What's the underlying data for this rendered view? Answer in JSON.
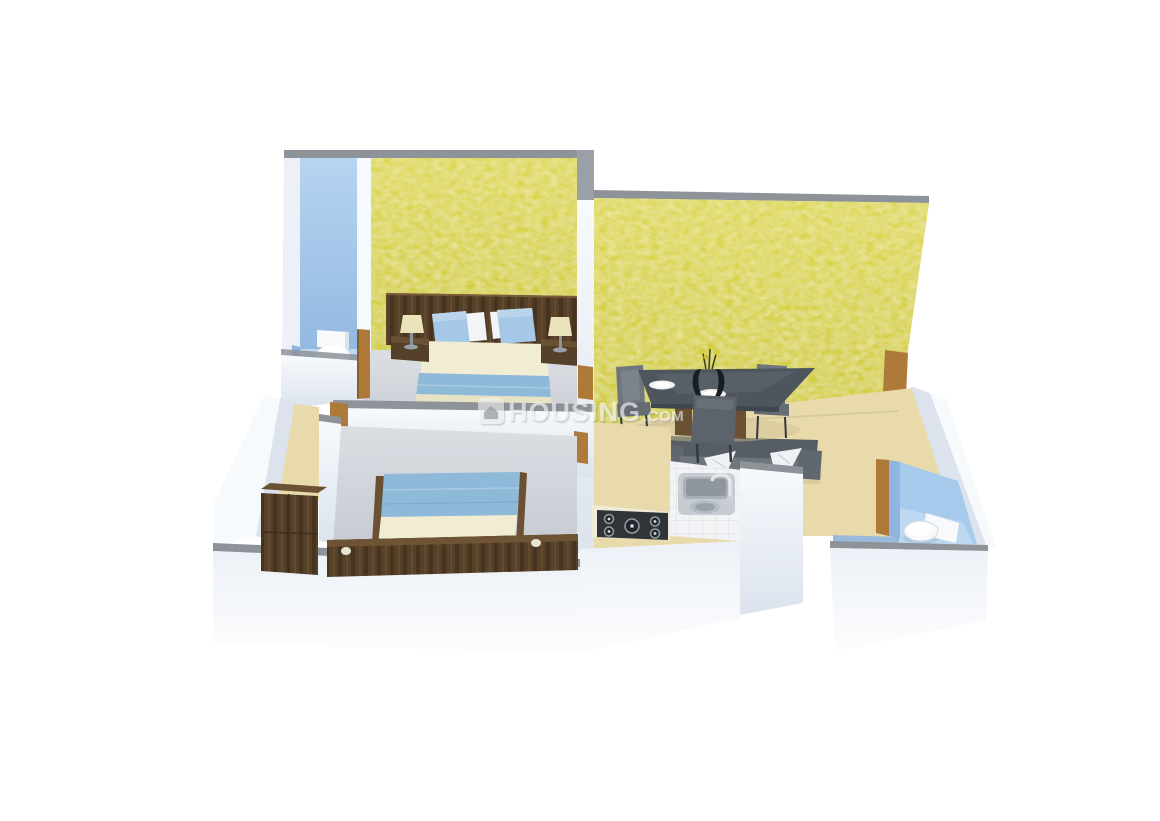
{
  "watermark": {
    "icon": "housing-logo-icon",
    "brand": "HOUSING",
    "suffix": ".COM"
  },
  "palette": {
    "background": "#ffffff",
    "yellow_wall": "#d2cd3f",
    "yellow_wall_light": "#ded957",
    "gray_wall_top": "#8e939a",
    "white_wall": "#edf1f7",
    "white_wall_bright": "#f7fafd",
    "white_wall_shadow": "#dde3ed",
    "blue_wall": "#a7cbed",
    "blue_wall_deep": "#8fb6e0",
    "blue_floor": "#bdd8f0",
    "beige_floor": "#e9daab",
    "beige_floor_deep": "#e0d09e",
    "gray_floor": "#d5d8dd",
    "wood_trim": "#ad7a3a",
    "wood_dark": "#55402a",
    "wood_mid": "#6b5134",
    "bed_cream": "#f0edd3",
    "bed_blue": "#8fb9d9",
    "pillow_blue": "#a5c8e6",
    "lamp_cream": "#eae2ba",
    "sofa_gray": "#565d64",
    "table_gray": "#4e555c",
    "chair_gray": "#70767e",
    "fixture_white": "#f7f9fb",
    "hob_black": "#2f3439",
    "steel": "#c7ccd2",
    "watermark": "#ffffff"
  },
  "scene": {
    "type": "3d-isometric-floor-plan",
    "rooms": [
      {
        "id": "bathroom-1",
        "wall_color_key": "blue_wall",
        "fixtures": [
          "toilet"
        ]
      },
      {
        "id": "bedroom-1",
        "wall_color_key": "yellow_wall",
        "furniture": [
          "double-bed",
          "headboard",
          "nightstand-left",
          "nightstand-right",
          "table-lamp-left",
          "table-lamp-right"
        ]
      },
      {
        "id": "living-dining",
        "wall_color_key": "yellow_wall",
        "furniture": [
          "dining-table",
          "dining-chair-left",
          "dining-chair-right",
          "dining-chair-front",
          "vase-with-flowers",
          "dinner-plates",
          "sofa",
          "throw-pillows"
        ]
      },
      {
        "id": "kitchen",
        "furniture": [
          "l-shaped-counter",
          "gas-hob",
          "double-sink",
          "faucet"
        ]
      },
      {
        "id": "hallway",
        "floor_color_key": "beige_floor"
      },
      {
        "id": "bathroom-2",
        "wall_color_key": "blue_wall",
        "fixtures": [
          "toilet"
        ]
      },
      {
        "id": "bedroom-2",
        "furniture": [
          "double-bed",
          "wood-bed-frame",
          "wardrobe"
        ]
      }
    ]
  }
}
